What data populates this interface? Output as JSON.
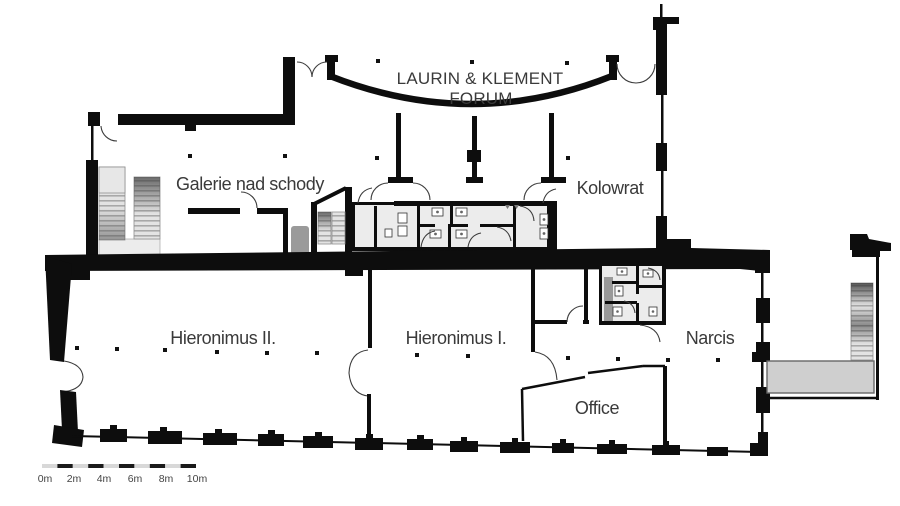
{
  "plan": {
    "rooms": {
      "forum": {
        "line1": "LAURIN & KLEMENT",
        "line2": "FORUM"
      },
      "galerie": {
        "label": "Galerie nad schody"
      },
      "kolowrat": {
        "label": "Kolowrat"
      },
      "hieronimus_ii": {
        "label": "Hieronimus II."
      },
      "hieronimus_i": {
        "label": "Hieronimus I."
      },
      "narcis": {
        "label": "Narcis"
      },
      "office": {
        "label": "Office"
      }
    },
    "scale_bar": {
      "labels": [
        "0m",
        "2m",
        "4m",
        "6m",
        "8m",
        "10m"
      ]
    },
    "colors": {
      "wall": "#0d0d0d",
      "label_text": "#3a3a3a",
      "room_fill": "#ececec",
      "shaft_fill": "#9a9a9a",
      "corridor_fill": "#cfcfcf",
      "scale_light": "#d8d8d8",
      "scale_dark": "#1a1a1a"
    }
  }
}
